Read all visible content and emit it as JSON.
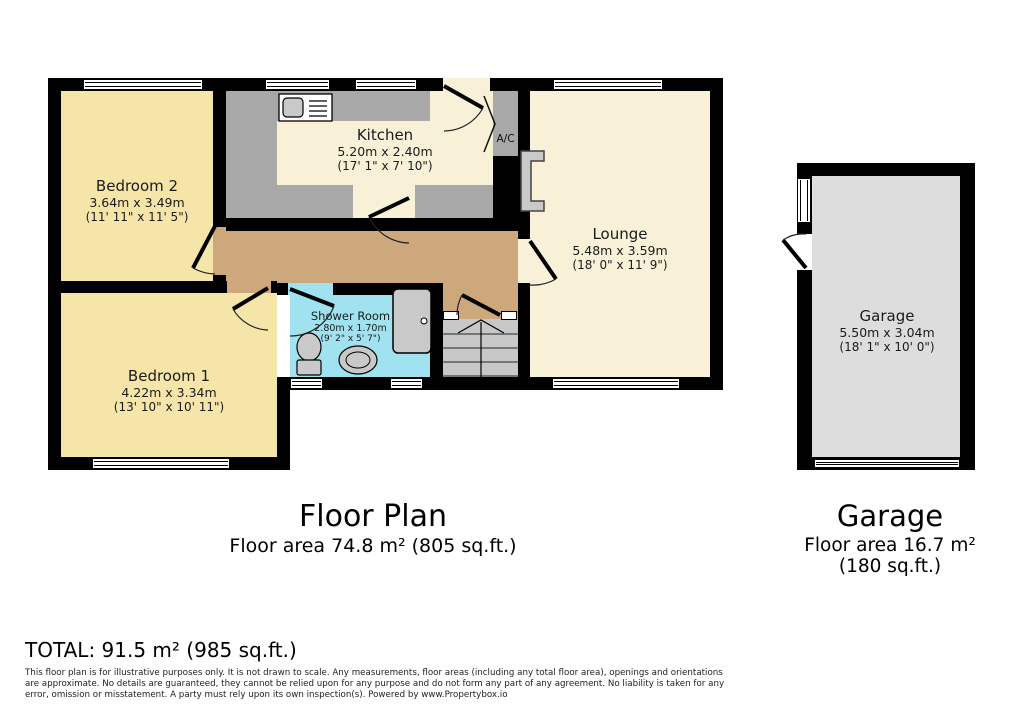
{
  "colors": {
    "wall": "#000000",
    "bedroom_fill": "#F5E5A8",
    "cream_fill": "#F8F1D8",
    "hall_fill": "#CCA87C",
    "shower_fill": "#A0E2F0",
    "counter_gray": "#A8A8A8",
    "stairs_gray": "#C8C8C8",
    "garage_floor": "#DDDDDD",
    "fixture_gray": "#C9C9C9"
  },
  "rooms": {
    "bedroom2": {
      "name": "Bedroom 2",
      "metric": "3.64m x 3.49m",
      "imperial": "(11' 11\" x 11' 5\")"
    },
    "kitchen": {
      "name": "Kitchen",
      "metric": "5.20m x 2.40m",
      "imperial": "(17' 1\" x 7' 10\")"
    },
    "lounge": {
      "name": "Lounge",
      "metric": "5.48m x 3.59m",
      "imperial": "(18' 0\" x 11' 9\")"
    },
    "bedroom1": {
      "name": "Bedroom 1",
      "metric": "4.22m x 3.34m",
      "imperial": "(13' 10\" x 10' 11\")"
    },
    "shower_room": {
      "name": "Shower Room",
      "metric": "2.80m x 1.70m",
      "imperial": "(9' 2\" x 5' 7\")"
    },
    "ac_closet": {
      "name": "A/C"
    },
    "garage": {
      "name": "Garage",
      "metric": "5.50m x 3.04m",
      "imperial": "(18' 1\" x 10' 0\")"
    }
  },
  "captions": {
    "floor_plan_title": "Floor Plan",
    "floor_plan_area": "Floor area 74.8 m² (805 sq.ft.)",
    "garage_title": "Garage",
    "garage_area": "Floor area 16.7 m² (180 sq.ft.)",
    "total": "TOTAL: 91.5 m² (985 sq.ft.)"
  },
  "disclaimer": "This floor plan is for illustrative purposes only. It is not drawn to scale. Any measurements, floor areas (including any total floor area), openings and orientations are approximate. No details are guaranteed, they cannot be relied upon for any purpose and do not form any part of any agreement. No liability is taken for any error, omission or misstatement. A party must rely upon its own inspection(s). Powered by www.Propertybox.io"
}
